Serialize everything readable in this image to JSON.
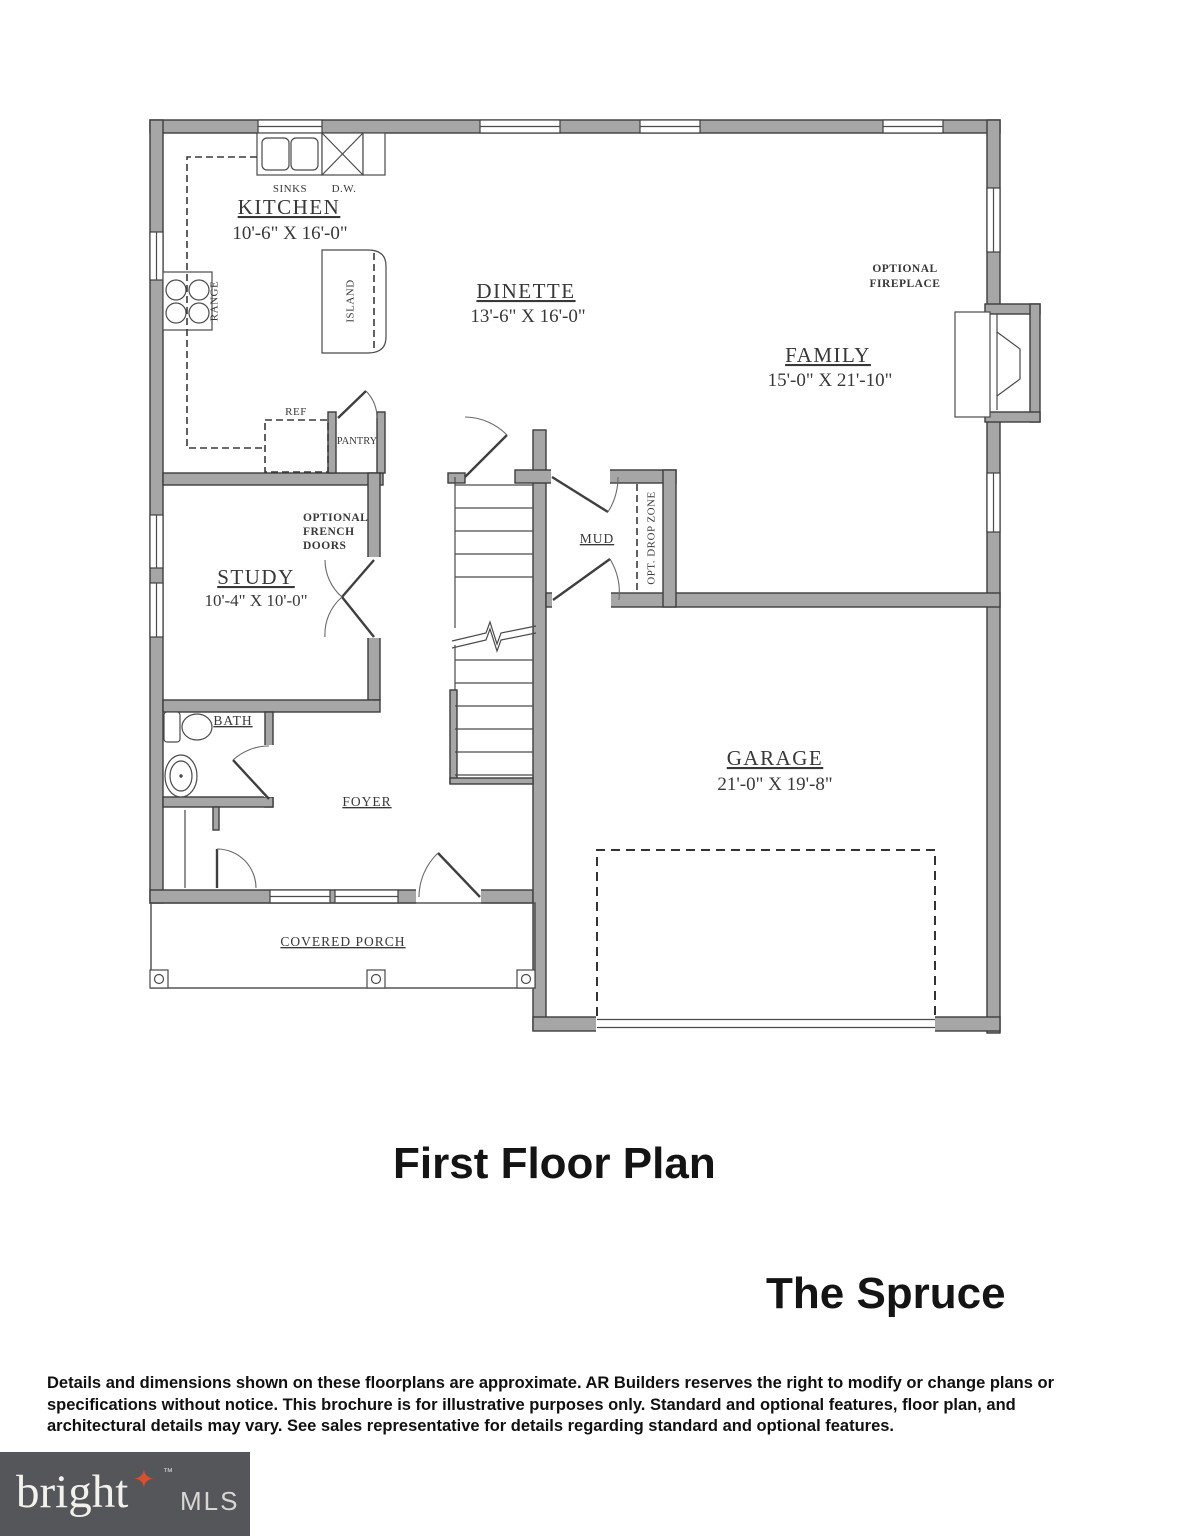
{
  "plan": {
    "rooms": {
      "kitchen": {
        "name": "KITCHEN",
        "dims": "10'-6\" X 16'-0\""
      },
      "dinette": {
        "name": "DINETTE",
        "dims": "13'-6\" X 16'-0\""
      },
      "family": {
        "name": "FAMILY",
        "dims": "15'-0\" X 21'-10\""
      },
      "study": {
        "name": "STUDY",
        "dims": "10'-4\" X 10'-0\""
      },
      "garage": {
        "name": "GARAGE",
        "dims": "21'-0\" X 19'-8\""
      },
      "mud": {
        "name": "MUD"
      },
      "bath": {
        "name": "BATH"
      },
      "foyer": {
        "name": "FOYER"
      },
      "covered_porch": {
        "name": "COVERED PORCH"
      }
    },
    "labels": {
      "sinks": "SINKS",
      "dw": "D.W.",
      "range": "RANGE",
      "island": "ISLAND",
      "ref": "REF",
      "pantry": "PANTRY",
      "optional_french_doors_line1": "OPTIONAL",
      "optional_french_doors_line2": "FRENCH",
      "optional_french_doors_line3": "DOORS",
      "optional_fireplace_line1": "OPTIONAL",
      "optional_fireplace_line2": "FIREPLACE",
      "opt_drop_zone": "OPT. DROP ZONE"
    }
  },
  "titles": {
    "floor": "First Floor Plan",
    "model": "The Spruce"
  },
  "disclaimer": {
    "line1": "Details and dimensions shown on these floorplans are approximate. AR Builders reserves the right to modify or change plans or",
    "line2": "specifications without notice. This brochure is for illustrative purposes only. Standard and optional features, floor plan, and",
    "line3": "architectural details may vary. See sales representative for details regarding standard and optional features."
  },
  "logo": {
    "brand": "bright",
    "trademark": "™",
    "suffix": "MLS",
    "star_glyph": "✦"
  },
  "colors": {
    "wall_fill": "#a6a6a6",
    "wall_stroke": "#3d3d3d",
    "label_text": "#383838",
    "logo_background": "#55565a",
    "logo_brand_text": "#f2f1ec",
    "logo_star": "#d9502c",
    "logo_suffix_text": "#d8d7d3"
  }
}
